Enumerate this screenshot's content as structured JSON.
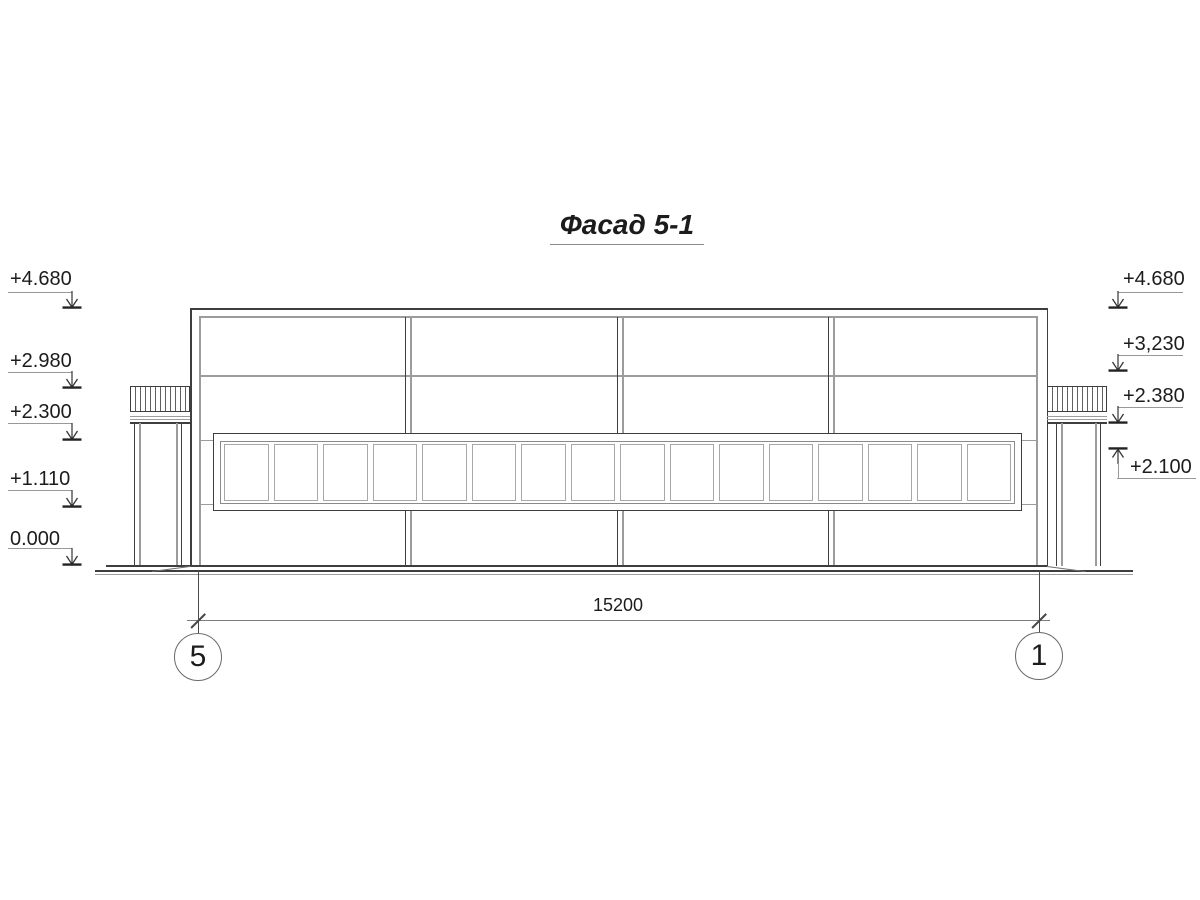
{
  "title": {
    "text": "Фасад 5-1"
  },
  "elevations": {
    "left": [
      {
        "label": "+4.680"
      },
      {
        "label": "+2.980"
      },
      {
        "label": "+2.300"
      },
      {
        "label": "+1.110"
      },
      {
        "label": "0.000"
      }
    ],
    "right": [
      {
        "label": "+4.680"
      },
      {
        "label": "+3,230"
      },
      {
        "label": "+2.380"
      },
      {
        "label": "+2.100"
      }
    ]
  },
  "dimension": {
    "value": "15200"
  },
  "grid_axes": [
    {
      "label": "5"
    },
    {
      "label": "1"
    }
  ],
  "facade": {
    "window_panes": 16
  },
  "colors": {
    "line_dark": "#3e3e3e",
    "line_gray": "#9c9c9c",
    "line_mid": "#8a8a8a",
    "pane_border": "#a8a8a8",
    "leader": "#999999",
    "text": "#1c1c1c",
    "background": "#ffffff"
  }
}
